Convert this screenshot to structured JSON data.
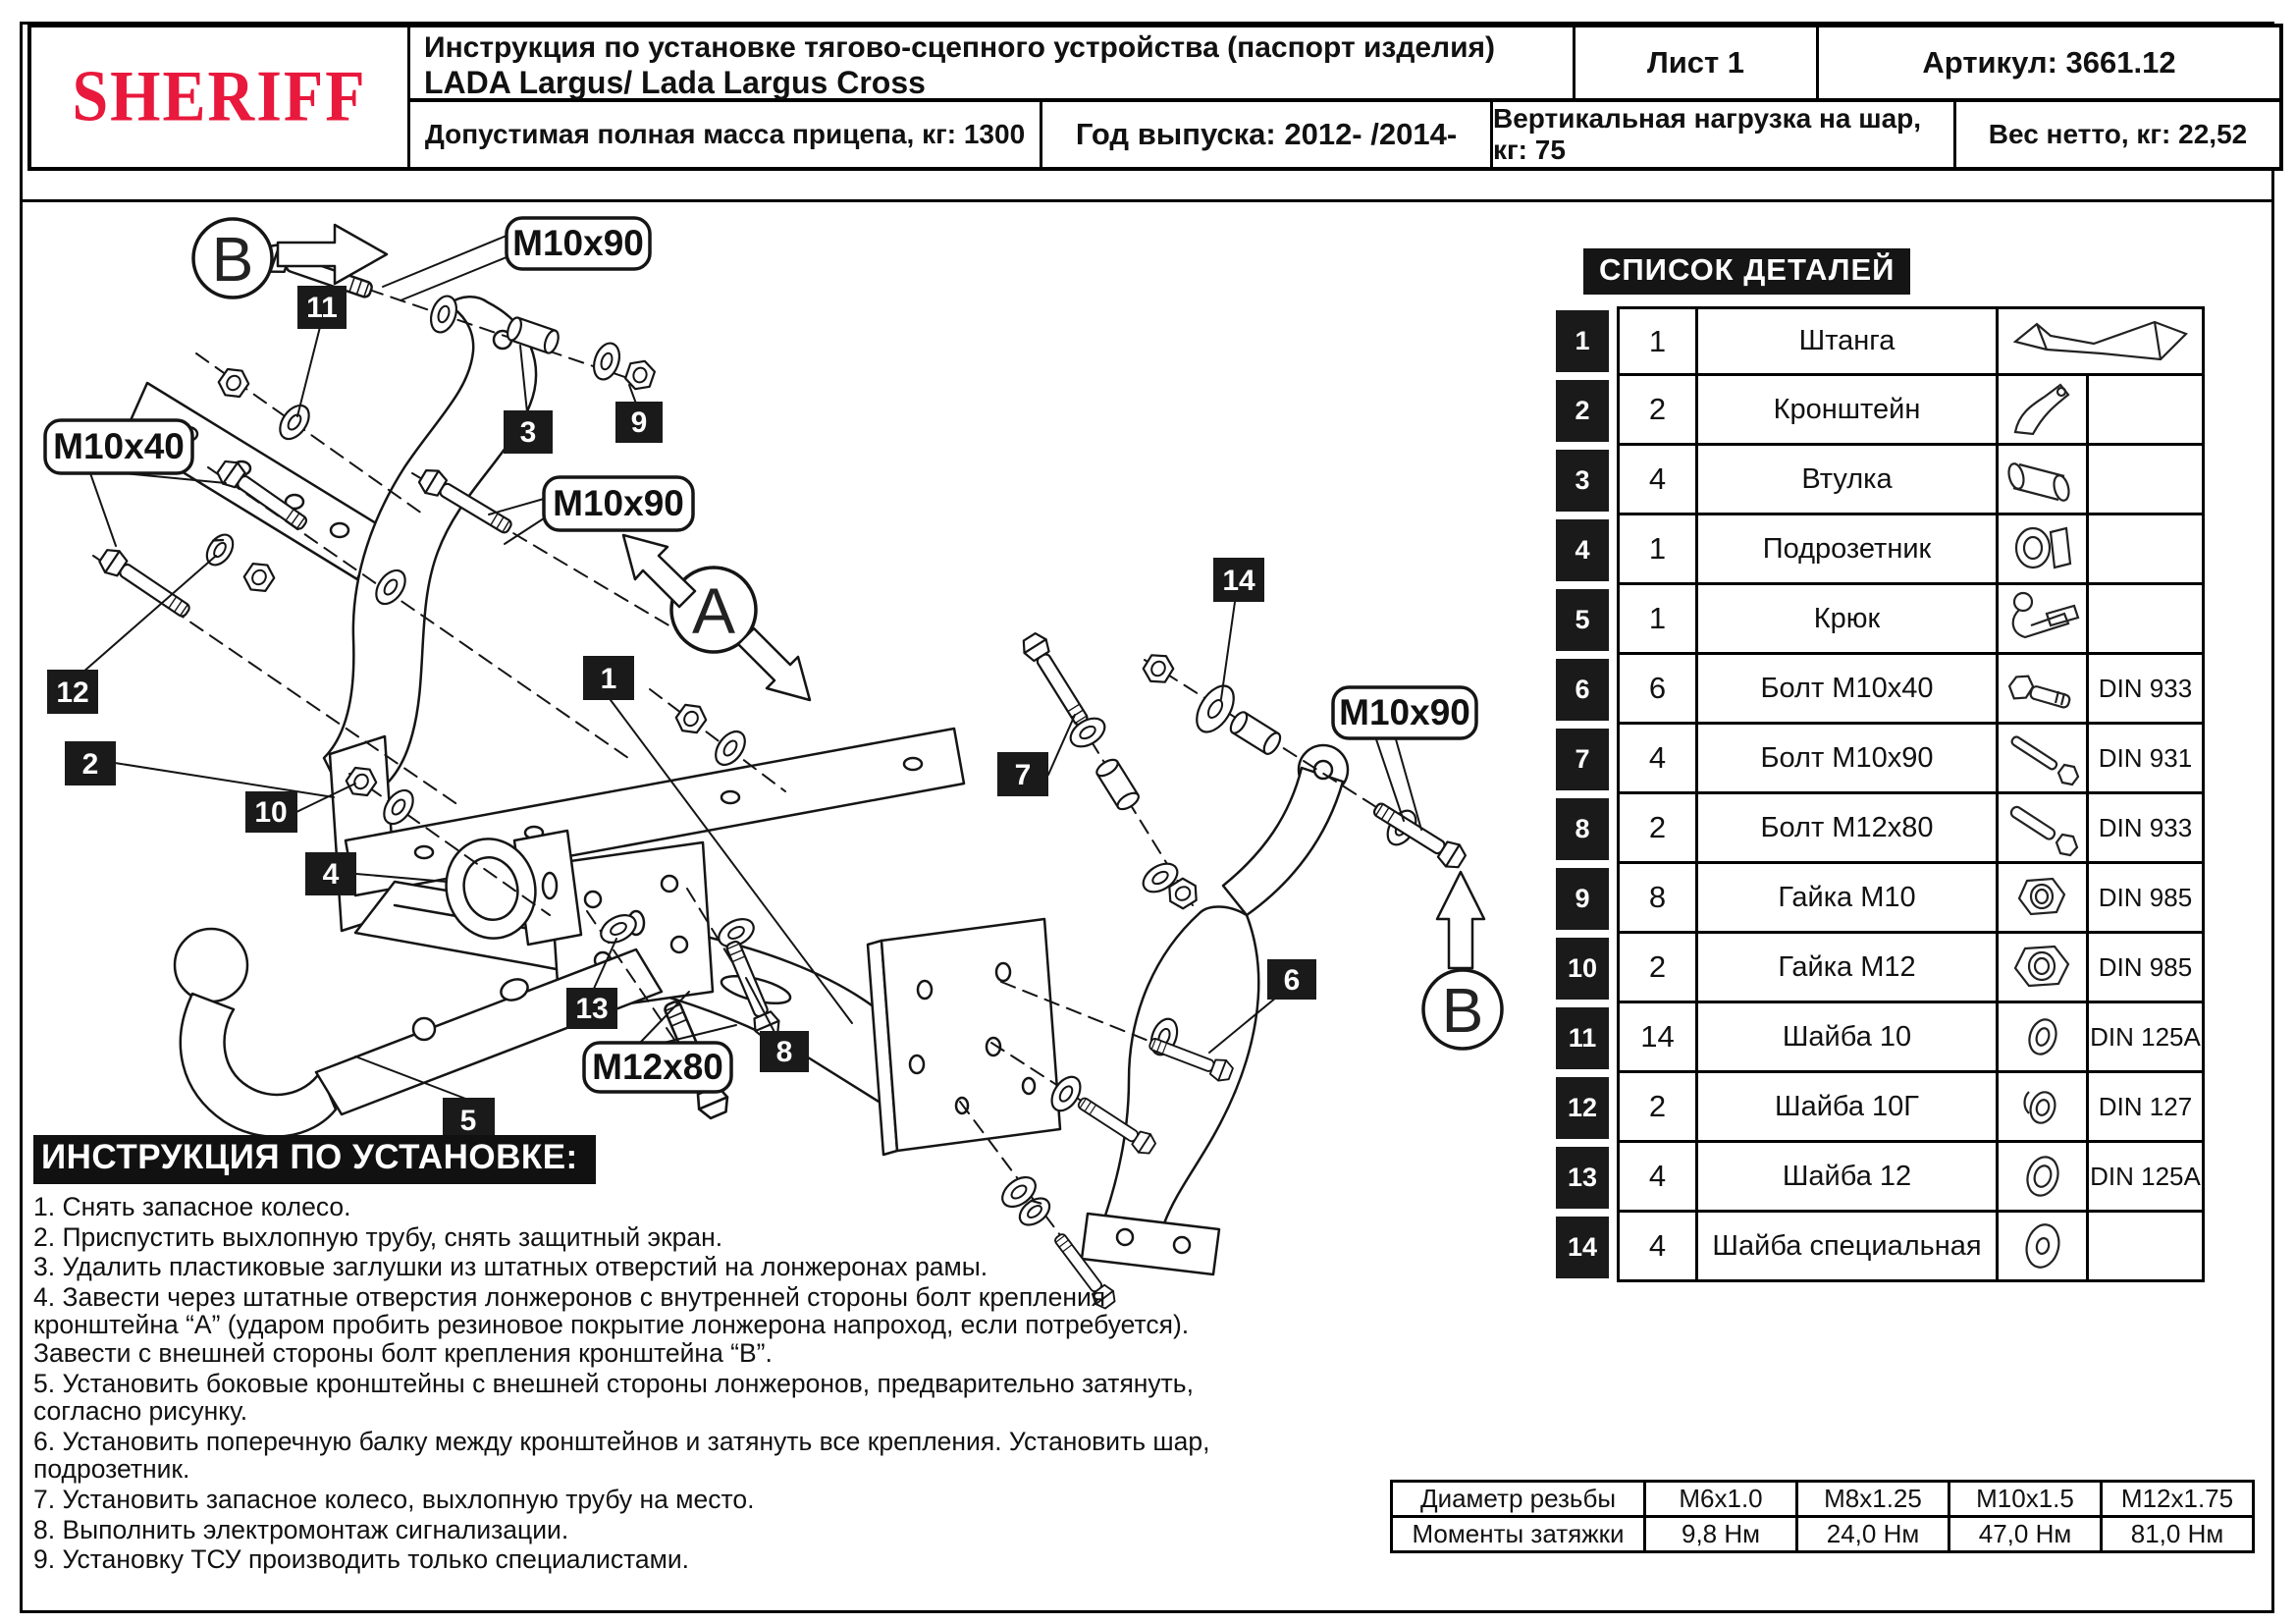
{
  "colors": {
    "brand_red": "#e8193c",
    "ink": "#111111",
    "box_black": "#1a1a1a"
  },
  "header": {
    "logo": "SHERIFF",
    "title_line1": "Инструкция по установке тягово-сцепного устройства (паспорт изделия)",
    "title_line2": "LADA Largus/ Lada Largus Cross",
    "sheet": "Лист 1",
    "article": "Артикул: 3661.12",
    "mass": "Допустимая полная масса прицепа, кг: 1300",
    "year": "Год выпуска: 2012- /2014-",
    "vertical_load": "Вертикальная нагрузка на шар, кг: 75",
    "net_weight": "Вес нетто, кг: 22,52"
  },
  "parts_list": {
    "title": "СПИСОК ДЕТАЛЕЙ",
    "rows": [
      {
        "num": "1",
        "qty": "1",
        "name": "Штанга",
        "din": "",
        "icon": "beam"
      },
      {
        "num": "2",
        "qty": "2",
        "name": "Кронштейн",
        "din": "",
        "icon": "bracket"
      },
      {
        "num": "3",
        "qty": "4",
        "name": "Втулка",
        "din": "",
        "icon": "bushing"
      },
      {
        "num": "4",
        "qty": "1",
        "name": "Подрозетник",
        "din": "",
        "icon": "socket"
      },
      {
        "num": "5",
        "qty": "1",
        "name": "Крюк",
        "din": "",
        "icon": "hook"
      },
      {
        "num": "6",
        "qty": "6",
        "name": "Болт М10х40",
        "din": "DIN 933",
        "icon": "bolt-short"
      },
      {
        "num": "7",
        "qty": "4",
        "name": "Болт М10х90",
        "din": "DIN 931",
        "icon": "bolt-long"
      },
      {
        "num": "8",
        "qty": "2",
        "name": "Болт М12х80",
        "din": "DIN 933",
        "icon": "bolt-long"
      },
      {
        "num": "9",
        "qty": "8",
        "name": "Гайка М10",
        "din": "DIN 985",
        "icon": "nut"
      },
      {
        "num": "10",
        "qty": "2",
        "name": "Гайка М12",
        "din": "DIN 985",
        "icon": "nut"
      },
      {
        "num": "11",
        "qty": "14",
        "name": "Шайба 10",
        "din": "DIN 125A",
        "icon": "washer"
      },
      {
        "num": "12",
        "qty": "2",
        "name": "Шайба 10Г",
        "din": "DIN 127",
        "icon": "spring-washer"
      },
      {
        "num": "13",
        "qty": "4",
        "name": "Шайба 12",
        "din": "DIN 125A",
        "icon": "washer"
      },
      {
        "num": "14",
        "qty": "4",
        "name": "Шайба специальная",
        "din": "",
        "icon": "washer-special"
      }
    ]
  },
  "instructions": {
    "title": "ИНСТРУКЦИЯ ПО УСТАНОВКЕ:",
    "steps": [
      "1. Снять запасное колесо.",
      "2. Приспустить выхлопную трубу, снять защитный экран.",
      "3. Удалить пластиковые заглушки из штатных отверстий на лонжеронах рамы.",
      "4. Завести через штатные отверстия лонжеронов с внутренней стороны болт крепления кронштейна “А” (ударом пробить резиновое покрытие лонжерона напроход, если потребуется). Завести с внешней стороны болт крепления кронштейна “В”.",
      "5. Установить боковые кронштейны с внешней стороны лонжеронов, предварительно затянуть, согласно рисунку.",
      "6. Установить поперечную балку между кронштейнов и затянуть все крепления. Установить шар, подрозетник.",
      "7. Установить запасное колесо, выхлопную трубу на место.",
      "8. Выполнить электромонтаж сигнализации.",
      "9. Установку ТСУ производить только специалистами."
    ]
  },
  "torque_table": {
    "diameter_label": "Диаметр резьбы",
    "torque_label": "Моменты затяжки",
    "diameters": [
      "М6х1.0",
      "М8х1.25",
      "М10х1.5",
      "М12х1.75"
    ],
    "torques": [
      "9,8 Нм",
      "24,0 Нм",
      "47,0 Нм",
      "81,0 Нм"
    ]
  },
  "diagram": {
    "view_labels": {
      "b_top": "B",
      "a": "A",
      "b_right": "B"
    },
    "callouts": {
      "top": "M10x90",
      "left": "M10x40",
      "mid": "M10x90",
      "right": "M10x90",
      "bottom": "M12x80"
    },
    "markers": {
      "m1": "1",
      "m2": "2",
      "m3": "3",
      "m4": "4",
      "m5": "5",
      "m6": "6",
      "m7": "7",
      "m8": "8",
      "m9": "9",
      "m10": "10",
      "m11": "11",
      "m12": "12",
      "m13": "13",
      "m14": "14"
    }
  }
}
